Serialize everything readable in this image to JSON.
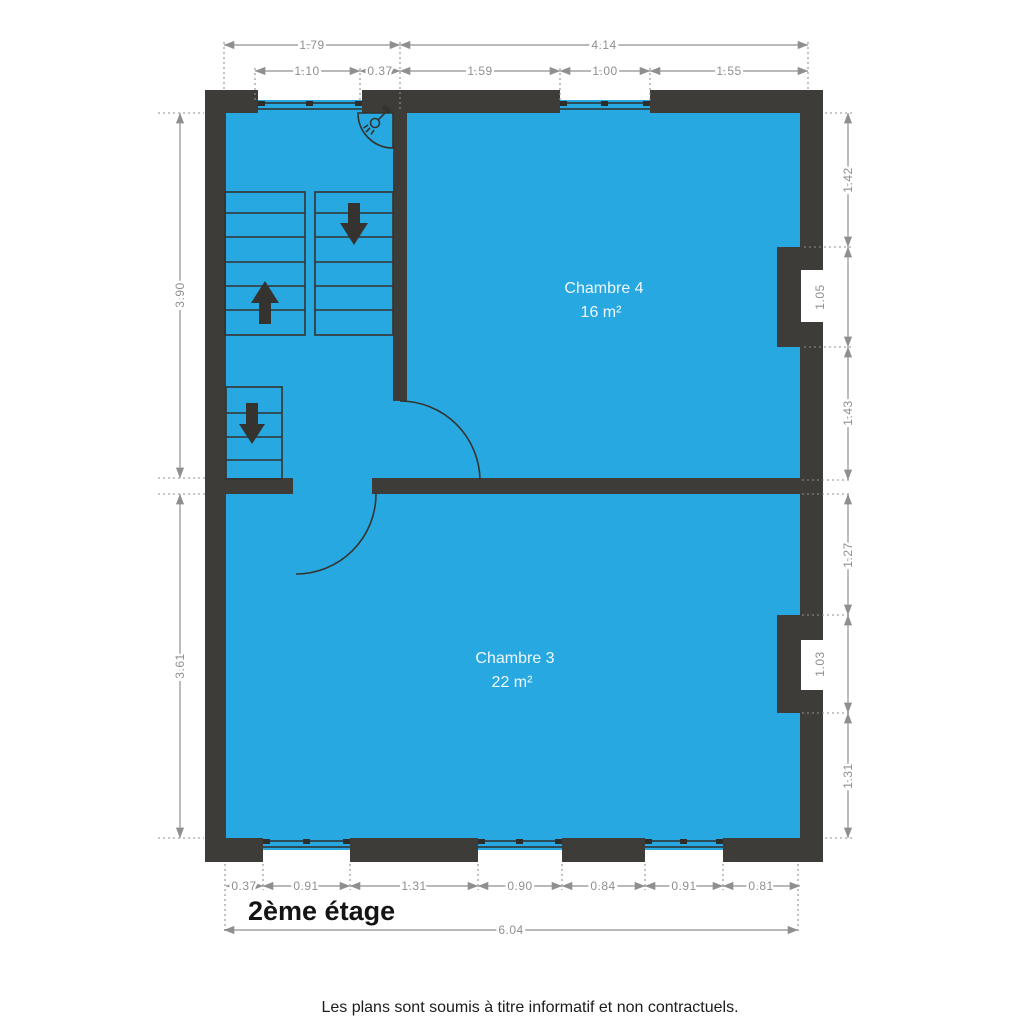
{
  "title": "2ème étage",
  "footer": "Les plans sont soumis à titre informatif et non contractuels.",
  "rooms": {
    "chambre4": {
      "name": "Chambre 4",
      "area": "16 m²"
    },
    "chambre3": {
      "name": "Chambre 3",
      "area": "22 m²"
    }
  },
  "dims": {
    "top_overall": [
      "1.79",
      "4.14"
    ],
    "top_detail": [
      "1.10",
      "0.37",
      "1.59",
      "1.00",
      "1.55"
    ],
    "left": [
      "3.90",
      "3.61"
    ],
    "right": [
      "1.42",
      "1.05",
      "1.43",
      "1.27",
      "1.03",
      "1.31"
    ],
    "bottom_detail": [
      "0.37",
      "0.91",
      "1.31",
      "0.90",
      "0.84",
      "0.91",
      "0.81"
    ],
    "bottom_overall": "6.04"
  },
  "colors": {
    "floor": "#28a8e0",
    "wall": "#3d3c39",
    "dimension": "#8f8f8f",
    "ink": "#141414"
  }
}
